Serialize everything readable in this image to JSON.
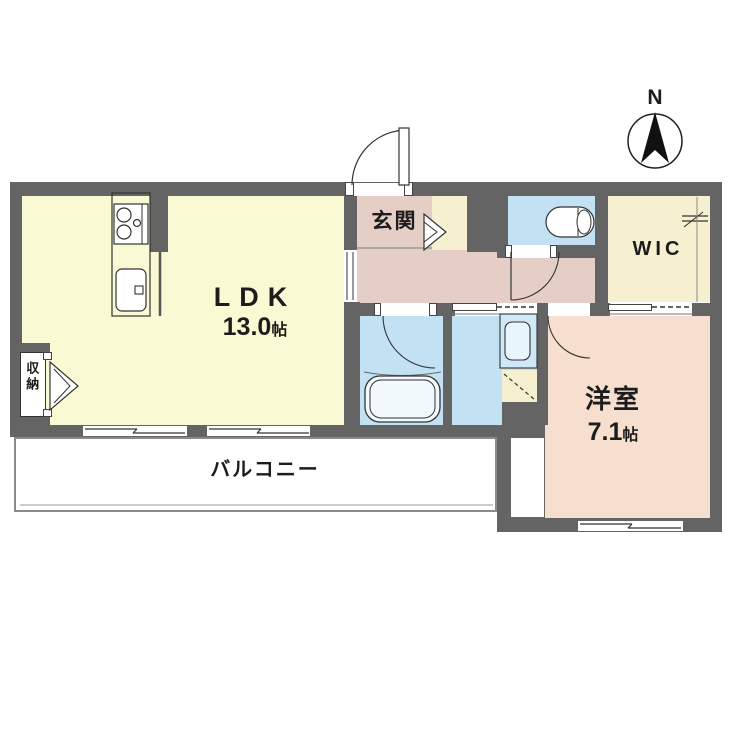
{
  "compass": {
    "label": "N"
  },
  "rooms": {
    "ldk": {
      "label": "LDK",
      "area_value": "13.0",
      "area_unit": "帖"
    },
    "bedroom": {
      "label": "洋室",
      "area_value": "7.1",
      "area_unit": "帖"
    },
    "entrance": {
      "label": "玄関"
    },
    "wic": {
      "label": "WIC"
    },
    "balcony": {
      "label": "バルコニー"
    },
    "storage": {
      "label": "収納"
    }
  },
  "fixtures": {
    "kitchen_stove": "two-burner-stove-icon",
    "kitchen_sink": "sink-icon",
    "bathtub": "bathtub-icon",
    "toilet": "toilet-icon",
    "vanity": "washbasin-icon",
    "washer_space": "washing-machine-space-icon",
    "hanger_pipe": "closet-hanger-icon",
    "compass": "north-arrow-icon"
  },
  "colors": {
    "wall": "#646464",
    "ldk_floor": "#F9F9D3",
    "hall_floor": "#E5CEC6",
    "bedroom_floor": "#F7DFD0",
    "wet_floor": "#C2E1F3",
    "closet_floor": "#F6F0D0",
    "balcony_floor": "#FFFFFF",
    "outline": "#333333"
  }
}
